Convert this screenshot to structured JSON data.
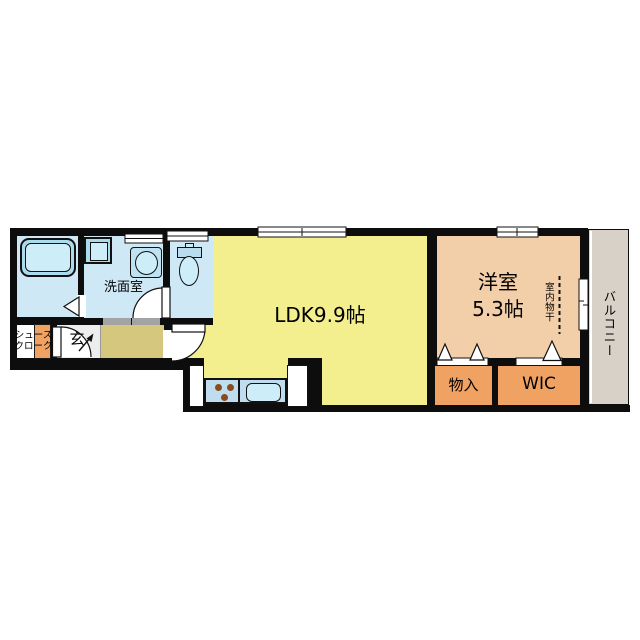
{
  "plan": {
    "type": "apartment-floor-plan-1LDK",
    "rooms": {
      "ldk": {
        "label": "LDK9.9帖"
      },
      "western": {
        "name": "洋室",
        "size": "5.3帖"
      },
      "washroom": {
        "label": "洗面室"
      },
      "entrance": {
        "label": "玄"
      },
      "shoe_closet": {
        "line1": "シュース",
        "line2": "クローク"
      },
      "storage": {
        "label": "物入"
      },
      "wic": {
        "label": "WIC"
      },
      "balcony": {
        "label": "バルコニー"
      }
    },
    "annotations": {
      "indoor_drying": "室内物干"
    },
    "colors": {
      "wall": "#0d0d0d",
      "ldk_yellow": "#f4ef8e",
      "hall_khaki": "#d6c77e",
      "western_peach": "#f2cfa9",
      "closet_orange": "#f0a263",
      "wet_room_blue": "#cfe8f6",
      "fixture_blue": "#aadced",
      "fixture_light_blue": "#cdeef8",
      "kitchen_counter_blue": "#c0ddef",
      "balcony_gray": "#d8d1c8",
      "entrance_gray": "#ededed",
      "slider_gray": "#a3a3a3",
      "stove_brown": "#8a4a1c"
    }
  }
}
